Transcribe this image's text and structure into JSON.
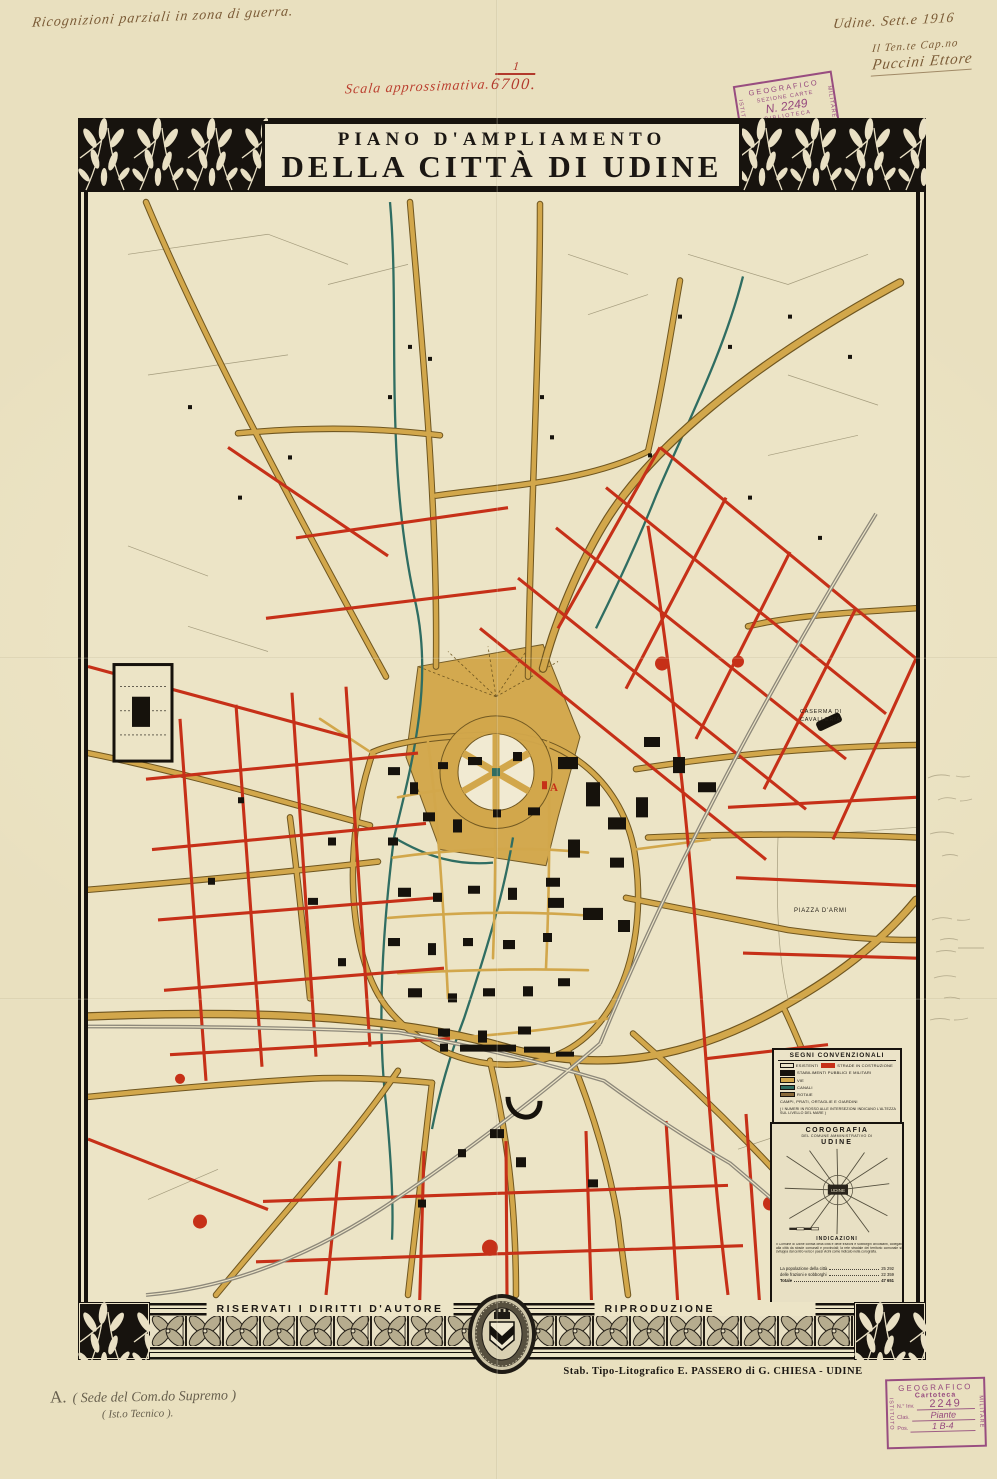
{
  "sheet": {
    "paper_color": "#e9e0bf"
  },
  "annotations": {
    "top_left": "Ricognizioni parziali in zona di guerra.",
    "date_line": "Udine. Sett.e 1916",
    "rank_line": "Il Ten.te Cap.no",
    "signature": "Puccini Ettore",
    "scale_label": "Scala approssimativa.",
    "scale_numerator": "1",
    "scale_denominator": "6700.",
    "bottom_note_marker": "A.",
    "bottom_note_text": "( Sede del Com.do Supremo )",
    "bottom_note_line2": "( Ist.o Tecnico )."
  },
  "title": {
    "line1": "PIANO D'AMPLIAMENTO",
    "line2": "DELLA CITTÀ DI UDINE"
  },
  "stamps": {
    "top": {
      "left": "ISTITUTO",
      "arc": "GEOGRAFICO",
      "right": "MILITARE",
      "row2": "SEZIONE CARTE",
      "row3": "N. 2249",
      "row4": "BIBLIOTECA"
    },
    "bottom": {
      "left": "ISTITUTO",
      "arc": "GEOGRAFICO",
      "right": "MILITARE",
      "row1": "Cartoteca",
      "inv_label": "N.° Inv.",
      "inv_value": "2249",
      "clas_label": "Clas.",
      "clas_value": "Piante",
      "pos_label": "Pos.",
      "pos_value": "1 B-4"
    }
  },
  "map": {
    "colors": {
      "paper": "#ece4c6",
      "road_tan": "#d2a74b",
      "road_casing": "#6f5620",
      "road_red": "#c63018",
      "canal": "#2f6d62",
      "rail": "#8d887a",
      "building": "#16120c"
    },
    "labels": {
      "caserma_line1": "CASERMA DI",
      "caserma_line2": "CAVALLERIA",
      "piazza_armi": "PIAZZA D'ARMI",
      "marker_a": "A"
    }
  },
  "legend": {
    "title": "SEGNI CONVENZIONALI",
    "rows": [
      [
        {
          "sw": "white",
          "label": "ESISTENTI"
        },
        {
          "sw": "red",
          "label": "STRADE IN COSTRUZIONE"
        }
      ],
      [
        {
          "sw": "black",
          "label": "STABILIMENTI PUBBLICI E MILITARI"
        }
      ],
      [
        {
          "sw": "tan",
          "label": "VIE"
        }
      ],
      [
        {
          "sw": "teal",
          "label": "CANALI"
        }
      ],
      [
        {
          "sw": "brown",
          "label": "ROTAIE"
        }
      ],
      [
        {
          "sw": "none",
          "label": "CAMPI, PRATI, ORTAGLIE E GIARDINI"
        }
      ]
    ],
    "note": "( I NUMERI IN ROSSO ALLE INTERSEZIONI INDICANO L'ALTEZZA SUL LIVELLO DEL MARE )"
  },
  "corografia": {
    "title": "COROGRAFIA",
    "subtitle": "DEL COMUNE AMMINISTRATIVO DI",
    "name": "UDINE",
    "map_center_label": "UDINE",
    "indicazioni_title": "INDICAZIONI",
    "indicazioni_text": "Il Comune di Udine consta della città e delle frazioni e sobborghi circostanti, collegati alla città da strade comunali e provinciali; la rete stradale del territorio comunale si sviluppa dal centro verso i paesi vicini come indicato nella corografia.",
    "stats": [
      {
        "label": "La popolazione della città",
        "value": "25 292"
      },
      {
        "label": "delle frazioni e sobborghi",
        "value": "22 359"
      },
      {
        "label": "Totale",
        "value": "47 651",
        "total": true
      }
    ]
  },
  "footer": {
    "rights_left": "RISERVATI I DIRITTI D'AUTORE",
    "rights_right": "RIPRODUZIONE INTERDETTA",
    "imprint": "Stab. Tipo-Litografico E. PASSERO di G. CHIESA - UDINE"
  }
}
